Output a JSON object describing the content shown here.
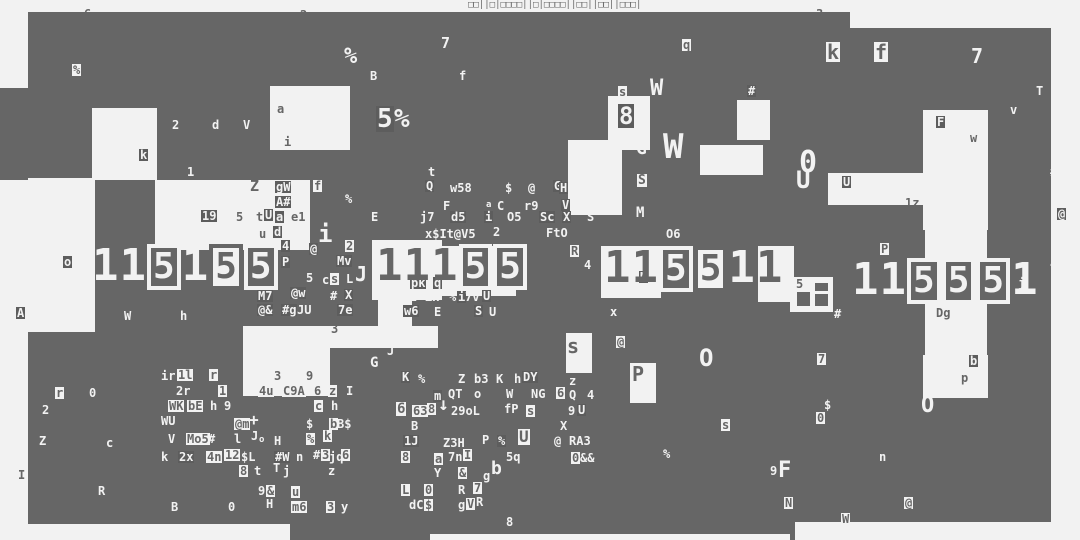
{
  "colors": {
    "background": "#f2f2f2",
    "block": "#666666",
    "box_dark": "#5d5d5d"
  },
  "top_strip": {
    "text": "□□||□|□□□□||□|□□□□||□□||□□||□□□|"
  },
  "blocks": {
    "dark": [
      [
        28,
        12,
        822,
        78
      ],
      [
        850,
        28,
        201,
        62
      ],
      [
        0,
        88,
        28,
        92
      ],
      [
        28,
        88,
        1023,
        152
      ],
      [
        28,
        240,
        1023,
        92
      ],
      [
        28,
        332,
        1023,
        208
      ]
    ],
    "light": [
      [
        92,
        108,
        65,
        72
      ],
      [
        270,
        86,
        80,
        64
      ],
      [
        155,
        180,
        155,
        70
      ],
      [
        28,
        178,
        67,
        154
      ],
      [
        243,
        326,
        195,
        22
      ],
      [
        243,
        348,
        87,
        48
      ],
      [
        372,
        240,
        70,
        60
      ],
      [
        440,
        246,
        76,
        50
      ],
      [
        378,
        296,
        34,
        30
      ],
      [
        568,
        140,
        54,
        75
      ],
      [
        700,
        145,
        63,
        30
      ],
      [
        737,
        100,
        33,
        40
      ],
      [
        608,
        96,
        42,
        54
      ],
      [
        828,
        173,
        100,
        32
      ],
      [
        923,
        110,
        65,
        120
      ],
      [
        601,
        246,
        60,
        52
      ],
      [
        758,
        246,
        36,
        56
      ],
      [
        925,
        228,
        62,
        134
      ],
      [
        790,
        277,
        43,
        35
      ],
      [
        923,
        355,
        65,
        43
      ],
      [
        566,
        333,
        26,
        40
      ],
      [
        630,
        363,
        26,
        40
      ],
      [
        28,
        524,
        262,
        16
      ],
      [
        430,
        534,
        360,
        6
      ],
      [
        795,
        522,
        256,
        18
      ]
    ],
    "panes": [
      [
        797,
        292,
        13,
        14
      ],
      [
        815,
        283,
        13,
        8
      ],
      [
        815,
        294,
        13,
        12
      ]
    ]
  },
  "big_digits": {
    "glyph_map": {
      "1": "1",
      "0": "5"
    },
    "clusters": [
      {
        "x": 92,
        "y": 244,
        "tokens": [
          "1w",
          "1w",
          "0d",
          "1w",
          "0l",
          "0d"
        ]
      },
      {
        "x": 376,
        "y": 244,
        "tokens": [
          "1d",
          "1d",
          "1d",
          "0d",
          "0d"
        ]
      },
      {
        "x": 604,
        "y": 246,
        "tokens": [
          "1d",
          "1d",
          "0d",
          "0l",
          "1w",
          "1d"
        ]
      },
      {
        "x": 852,
        "y": 258,
        "tokens": [
          "1w",
          "1w",
          "0d",
          "0d",
          "0d",
          "1w"
        ]
      }
    ]
  },
  "glyph_format": "[text,x,y,style(w=light,d=dark,wb=light-on-darkbox,db=dark-on-lightbox),size?]",
  "glyphs": [
    [
      "6",
      84,
      8,
      "d"
    ],
    [
      "2",
      300,
      9,
      "d"
    ],
    [
      "3",
      816,
      8,
      "d"
    ],
    [
      "%",
      72,
      64,
      "db"
    ],
    [
      "%",
      344,
      46,
      "w",
      22
    ],
    [
      "B",
      370,
      70,
      "w"
    ],
    [
      "7",
      441,
      36,
      "w",
      15
    ],
    [
      "f",
      459,
      70,
      "w"
    ],
    [
      "5",
      376,
      106,
      "wb",
      26
    ],
    [
      "%",
      394,
      106,
      "w",
      26
    ],
    [
      "a",
      277,
      103,
      "d"
    ],
    [
      "2",
      172,
      119,
      "w"
    ],
    [
      "d",
      212,
      119,
      "w"
    ],
    [
      "V",
      243,
      119,
      "w"
    ],
    [
      "i",
      284,
      136,
      "d"
    ],
    [
      "k",
      139,
      149,
      "wb"
    ],
    [
      "1",
      187,
      166,
      "w"
    ],
    [
      "q",
      682,
      39,
      "db"
    ],
    [
      "s",
      618,
      86,
      "db"
    ],
    [
      "W",
      650,
      78,
      "w",
      22
    ],
    [
      "#",
      747,
      85,
      "wb"
    ],
    [
      "8",
      618,
      104,
      "wb",
      24
    ],
    [
      "G",
      636,
      140,
      "w",
      18
    ],
    [
      "W",
      663,
      130,
      "w",
      34
    ],
    [
      "k",
      826,
      42,
      "db",
      20
    ],
    [
      "f",
      874,
      42,
      "db",
      20
    ],
    [
      "7",
      971,
      46,
      "w",
      20
    ],
    [
      "T",
      1036,
      85,
      "w"
    ],
    [
      "v",
      1010,
      104,
      "w"
    ],
    [
      "F",
      936,
      116,
      "wb"
    ],
    [
      "w",
      970,
      132,
      "d"
    ],
    [
      "#",
      1050,
      166,
      "w"
    ],
    [
      "@",
      1057,
      208,
      "wb"
    ],
    [
      "0",
      799,
      148,
      "w",
      30
    ],
    [
      "U",
      796,
      168,
      "w",
      24
    ],
    [
      "U",
      842,
      176,
      "wb"
    ],
    [
      "1z",
      905,
      197,
      "d"
    ],
    [
      "t",
      428,
      166,
      "w"
    ],
    [
      "Q",
      425,
      180,
      "wb"
    ],
    [
      "w58",
      450,
      182,
      "w"
    ],
    [
      "$",
      505,
      182,
      "w"
    ],
    [
      "@",
      528,
      182,
      "w"
    ],
    [
      "G",
      553,
      180,
      "wb"
    ],
    [
      "H",
      565,
      181,
      "w"
    ],
    [
      "F",
      443,
      200,
      "w"
    ],
    [
      "a",
      486,
      201,
      "w",
      9
    ],
    [
      "C",
      497,
      200,
      "w"
    ],
    [
      "r9",
      524,
      200,
      "w"
    ],
    [
      "V",
      561,
      199,
      "wb"
    ],
    [
      "&",
      582,
      199,
      "w"
    ],
    [
      "j7",
      420,
      211,
      "w"
    ],
    [
      "d5",
      450,
      211,
      "wb"
    ],
    [
      "i",
      484,
      211,
      "wb"
    ],
    [
      "O5",
      507,
      211,
      "w"
    ],
    [
      "Sc",
      539,
      211,
      "wb"
    ],
    [
      "X",
      562,
      211,
      "wb"
    ],
    [
      "S",
      587,
      211,
      "w"
    ],
    [
      "x$It@V5",
      425,
      228,
      "w"
    ],
    [
      "2",
      493,
      226,
      "w"
    ],
    [
      "FtO",
      546,
      227,
      "w"
    ],
    [
      "R",
      570,
      245,
      "db"
    ],
    [
      "p",
      464,
      247,
      "w"
    ],
    [
      "Z",
      250,
      179,
      "d",
      15
    ],
    [
      "gW",
      275,
      181,
      "wb"
    ],
    [
      "f",
      313,
      180,
      "db"
    ],
    [
      "A#",
      275,
      196,
      "wb"
    ],
    [
      "%",
      345,
      193,
      "w"
    ],
    [
      "19",
      201,
      210,
      "wb"
    ],
    [
      "5",
      236,
      211,
      "d"
    ],
    [
      "t",
      256,
      211,
      "d"
    ],
    [
      "U",
      264,
      209,
      "wb"
    ],
    [
      "a",
      275,
      211,
      "wb"
    ],
    [
      "e1",
      291,
      211,
      "d"
    ],
    [
      "E",
      371,
      211,
      "w"
    ],
    [
      "u",
      259,
      228,
      "d"
    ],
    [
      "d",
      273,
      226,
      "wb"
    ],
    [
      "i",
      318,
      222,
      "w",
      24
    ],
    [
      "2",
      345,
      240,
      "db"
    ],
    [
      "@",
      309,
      243,
      "wb"
    ],
    [
      "4",
      281,
      240,
      "wb"
    ],
    [
      "P",
      281,
      256,
      "wb"
    ],
    [
      "5",
      306,
      272,
      "w"
    ],
    [
      "c",
      322,
      274,
      "w"
    ],
    [
      "s",
      330,
      273,
      "db"
    ],
    [
      "L",
      346,
      273,
      "w"
    ],
    [
      "#",
      330,
      290,
      "w"
    ],
    [
      "X",
      344,
      289,
      "wb"
    ],
    [
      "M7",
      257,
      290,
      "wb"
    ],
    [
      "@w",
      290,
      287,
      "wb"
    ],
    [
      "@&",
      257,
      304,
      "wb"
    ],
    [
      "#g",
      281,
      304,
      "wb"
    ],
    [
      "JU",
      297,
      304,
      "w"
    ],
    [
      "7e",
      337,
      304,
      "wb"
    ],
    [
      "W",
      124,
      310,
      "w"
    ],
    [
      "h",
      180,
      310,
      "w"
    ],
    [
      "o",
      63,
      256,
      "wb"
    ],
    [
      "A",
      16,
      307,
      "wb"
    ],
    [
      "3",
      331,
      323,
      "d"
    ],
    [
      "J",
      387,
      345,
      "w"
    ],
    [
      "G",
      370,
      356,
      "w",
      14
    ],
    [
      "Mv",
      336,
      255,
      "wb"
    ],
    [
      "J",
      355,
      264,
      "w",
      20
    ],
    [
      "P",
      464,
      244,
      "wb"
    ],
    [
      "pk",
      410,
      277,
      "wb"
    ],
    [
      "q",
      433,
      277,
      "wb"
    ],
    [
      "D",
      464,
      277,
      "wb"
    ],
    [
      "2",
      410,
      291,
      "w"
    ],
    [
      "Zx",
      425,
      291,
      "w"
    ],
    [
      "%",
      449,
      291,
      "w"
    ],
    [
      "i",
      457,
      291,
      "wb"
    ],
    [
      "7v",
      465,
      291,
      "w"
    ],
    [
      "U",
      482,
      290,
      "wb"
    ],
    [
      "w6",
      403,
      305,
      "wb"
    ],
    [
      "E",
      434,
      306,
      "w"
    ],
    [
      "S",
      474,
      305,
      "wb"
    ],
    [
      "U",
      489,
      306,
      "w"
    ],
    [
      "x",
      610,
      306,
      "w"
    ],
    [
      "M",
      639,
      271,
      "wb"
    ],
    [
      "@",
      616,
      336,
      "db"
    ],
    [
      "H",
      559,
      182,
      "wb"
    ],
    [
      "O6",
      666,
      228,
      "w"
    ],
    [
      "M",
      636,
      206,
      "w",
      14
    ],
    [
      "S",
      637,
      174,
      "db",
      13
    ],
    [
      "4",
      584,
      259,
      "w"
    ],
    [
      "s",
      567,
      336,
      "d",
      20
    ],
    [
      "P",
      632,
      364,
      "d",
      20
    ],
    [
      "O",
      699,
      346,
      "w",
      24
    ],
    [
      "z",
      569,
      375,
      "w"
    ],
    [
      "6",
      556,
      387,
      "db"
    ],
    [
      "Q",
      569,
      389,
      "w"
    ],
    [
      "4",
      587,
      389,
      "w"
    ],
    [
      "9",
      568,
      405,
      "w"
    ],
    [
      "U",
      577,
      404,
      "wb"
    ],
    [
      "X",
      560,
      420,
      "w"
    ],
    [
      "s",
      721,
      419,
      "db"
    ],
    [
      "%",
      663,
      448,
      "w"
    ],
    [
      "P",
      880,
      243,
      "db"
    ],
    [
      "#",
      834,
      308,
      "w"
    ],
    [
      "Dg",
      936,
      307,
      "d"
    ],
    [
      "4",
      1050,
      258,
      "w"
    ],
    [
      "j",
      1018,
      277,
      "w"
    ],
    [
      "5",
      795,
      278,
      "db"
    ],
    [
      "7",
      817,
      353,
      "db"
    ],
    [
      "b",
      969,
      355,
      "wb"
    ],
    [
      "p",
      961,
      372,
      "d"
    ],
    [
      "$",
      824,
      399,
      "w"
    ],
    [
      "0",
      816,
      412,
      "db"
    ],
    [
      "O",
      921,
      395,
      "w",
      22
    ],
    [
      "n",
      879,
      451,
      "w"
    ],
    [
      "9",
      770,
      465,
      "w"
    ],
    [
      "F",
      778,
      460,
      "w",
      22
    ],
    [
      "N",
      784,
      497,
      "db"
    ],
    [
      "@",
      904,
      497,
      "db"
    ],
    [
      "W",
      841,
      513,
      "db"
    ],
    [
      "r",
      55,
      387,
      "db"
    ],
    [
      "0",
      89,
      387,
      "w"
    ],
    [
      "2",
      42,
      404,
      "w"
    ],
    [
      "Z",
      39,
      435,
      "w"
    ],
    [
      "c",
      106,
      437,
      "w"
    ],
    [
      "I",
      17,
      469,
      "db"
    ],
    [
      "R",
      98,
      485,
      "w"
    ],
    [
      "ir",
      161,
      370,
      "w"
    ],
    [
      "1l",
      177,
      369,
      "db"
    ],
    [
      "r",
      209,
      369,
      "db"
    ],
    [
      "3",
      274,
      370,
      "d"
    ],
    [
      "9",
      306,
      370,
      "d"
    ],
    [
      "2r",
      176,
      385,
      "w"
    ],
    [
      "1",
      218,
      385,
      "db"
    ],
    [
      "4u",
      258,
      385,
      "db"
    ],
    [
      "C9A",
      282,
      385,
      "db"
    ],
    [
      "6",
      314,
      385,
      "d"
    ],
    [
      "z",
      328,
      385,
      "db"
    ],
    [
      "I",
      346,
      385,
      "w"
    ],
    [
      "WK",
      168,
      400,
      "db"
    ],
    [
      "bE",
      187,
      400,
      "db"
    ],
    [
      "h",
      210,
      400,
      "w"
    ],
    [
      "9",
      224,
      400,
      "w"
    ],
    [
      "Fg",
      254,
      402,
      "d"
    ],
    [
      "c",
      314,
      400,
      "db"
    ],
    [
      "h",
      331,
      400,
      "w"
    ],
    [
      "WU",
      161,
      415,
      "w"
    ],
    [
      "@m",
      234,
      418,
      "db"
    ],
    [
      "+",
      249,
      412,
      "w",
      16
    ],
    [
      "$",
      306,
      418,
      "w"
    ],
    [
      "b",
      329,
      418,
      "db"
    ],
    [
      "B$",
      337,
      418,
      "w"
    ],
    [
      "V",
      168,
      433,
      "w"
    ],
    [
      "Mo5",
      186,
      433,
      "db"
    ],
    [
      "#",
      208,
      433,
      "w"
    ],
    [
      "l",
      234,
      433,
      "w"
    ],
    [
      "J",
      251,
      430,
      "w"
    ],
    [
      "o",
      259,
      436,
      "w",
      9
    ],
    [
      "H",
      274,
      435,
      "w"
    ],
    [
      "%",
      306,
      433,
      "db"
    ],
    [
      "k",
      323,
      430,
      "db"
    ],
    [
      "k",
      161,
      451,
      "w"
    ],
    [
      "2x",
      178,
      451,
      "wb"
    ],
    [
      "4n",
      206,
      451,
      "db"
    ],
    [
      "12",
      224,
      449,
      "db"
    ],
    [
      "$L",
      241,
      451,
      "w"
    ],
    [
      "#W",
      274,
      451,
      "wb"
    ],
    [
      "n",
      296,
      451,
      "w"
    ],
    [
      "#",
      313,
      449,
      "w"
    ],
    [
      "3",
      321,
      449,
      "db"
    ],
    [
      "jq",
      329,
      451,
      "w"
    ],
    [
      "6",
      341,
      449,
      "db"
    ],
    [
      "8",
      239,
      465,
      "db"
    ],
    [
      "t",
      254,
      465,
      "w"
    ],
    [
      "T",
      273,
      462,
      "w"
    ],
    [
      "j",
      283,
      465,
      "w"
    ],
    [
      "z",
      328,
      465,
      "w"
    ],
    [
      "9",
      258,
      485,
      "w"
    ],
    [
      "&",
      266,
      485,
      "db"
    ],
    [
      "u",
      291,
      486,
      "db"
    ],
    [
      "B",
      171,
      501,
      "w"
    ],
    [
      "0",
      228,
      501,
      "w"
    ],
    [
      "H",
      266,
      498,
      "w"
    ],
    [
      "m6",
      291,
      501,
      "db"
    ],
    [
      "3",
      326,
      501,
      "db"
    ],
    [
      "y",
      341,
      501,
      "w"
    ],
    [
      "K",
      401,
      371,
      "wb"
    ],
    [
      "%",
      418,
      373,
      "w"
    ],
    [
      "Z",
      458,
      373,
      "w"
    ],
    [
      "b3",
      474,
      373,
      "w"
    ],
    [
      "K",
      496,
      373,
      "w"
    ],
    [
      "h",
      514,
      373,
      "w"
    ],
    [
      "DY",
      522,
      371,
      "wb"
    ],
    [
      "m",
      433,
      390,
      "wb"
    ],
    [
      "QT",
      448,
      388,
      "w"
    ],
    [
      "o",
      474,
      388,
      "w"
    ],
    [
      "W",
      506,
      388,
      "w"
    ],
    [
      "NG",
      531,
      388,
      "w"
    ],
    [
      "6",
      396,
      402,
      "db",
      14
    ],
    [
      "63",
      412,
      405,
      "db"
    ],
    [
      "8",
      427,
      403,
      "db"
    ],
    [
      "↓",
      438,
      396,
      "w",
      18
    ],
    [
      "29oL",
      451,
      405,
      "w"
    ],
    [
      "fP",
      504,
      403,
      "w"
    ],
    [
      "s",
      526,
      405,
      "db"
    ],
    [
      "B",
      411,
      420,
      "w"
    ],
    [
      "1J",
      403,
      435,
      "wb"
    ],
    [
      "Z3H",
      443,
      437,
      "w"
    ],
    [
      "P",
      482,
      434,
      "w"
    ],
    [
      "%",
      497,
      435,
      "wb"
    ],
    [
      "U",
      518,
      429,
      "db",
      16
    ],
    [
      "@",
      554,
      435,
      "w"
    ],
    [
      "RA3",
      569,
      435,
      "w"
    ],
    [
      "8",
      401,
      451,
      "db"
    ],
    [
      "a",
      434,
      453,
      "db"
    ],
    [
      "7n",
      448,
      451,
      "w"
    ],
    [
      "I",
      463,
      449,
      "db"
    ],
    [
      "5q",
      506,
      451,
      "w"
    ],
    [
      "0",
      571,
      452,
      "db"
    ],
    [
      "&&",
      580,
      452,
      "w"
    ],
    [
      "Y",
      434,
      467,
      "w"
    ],
    [
      "&",
      458,
      467,
      "db"
    ],
    [
      "g",
      483,
      470,
      "w"
    ],
    [
      "b",
      491,
      460,
      "w",
      18
    ],
    [
      "L",
      401,
      484,
      "db"
    ],
    [
      "0",
      424,
      484,
      "db"
    ],
    [
      "R",
      458,
      484,
      "w"
    ],
    [
      "7",
      473,
      482,
      "db"
    ],
    [
      "dC",
      409,
      499,
      "w"
    ],
    [
      "$",
      424,
      499,
      "db"
    ],
    [
      "g",
      458,
      499,
      "w"
    ],
    [
      "V",
      466,
      498,
      "db"
    ],
    [
      "R",
      476,
      496,
      "w"
    ],
    [
      "8",
      506,
      516,
      "w"
    ]
  ]
}
